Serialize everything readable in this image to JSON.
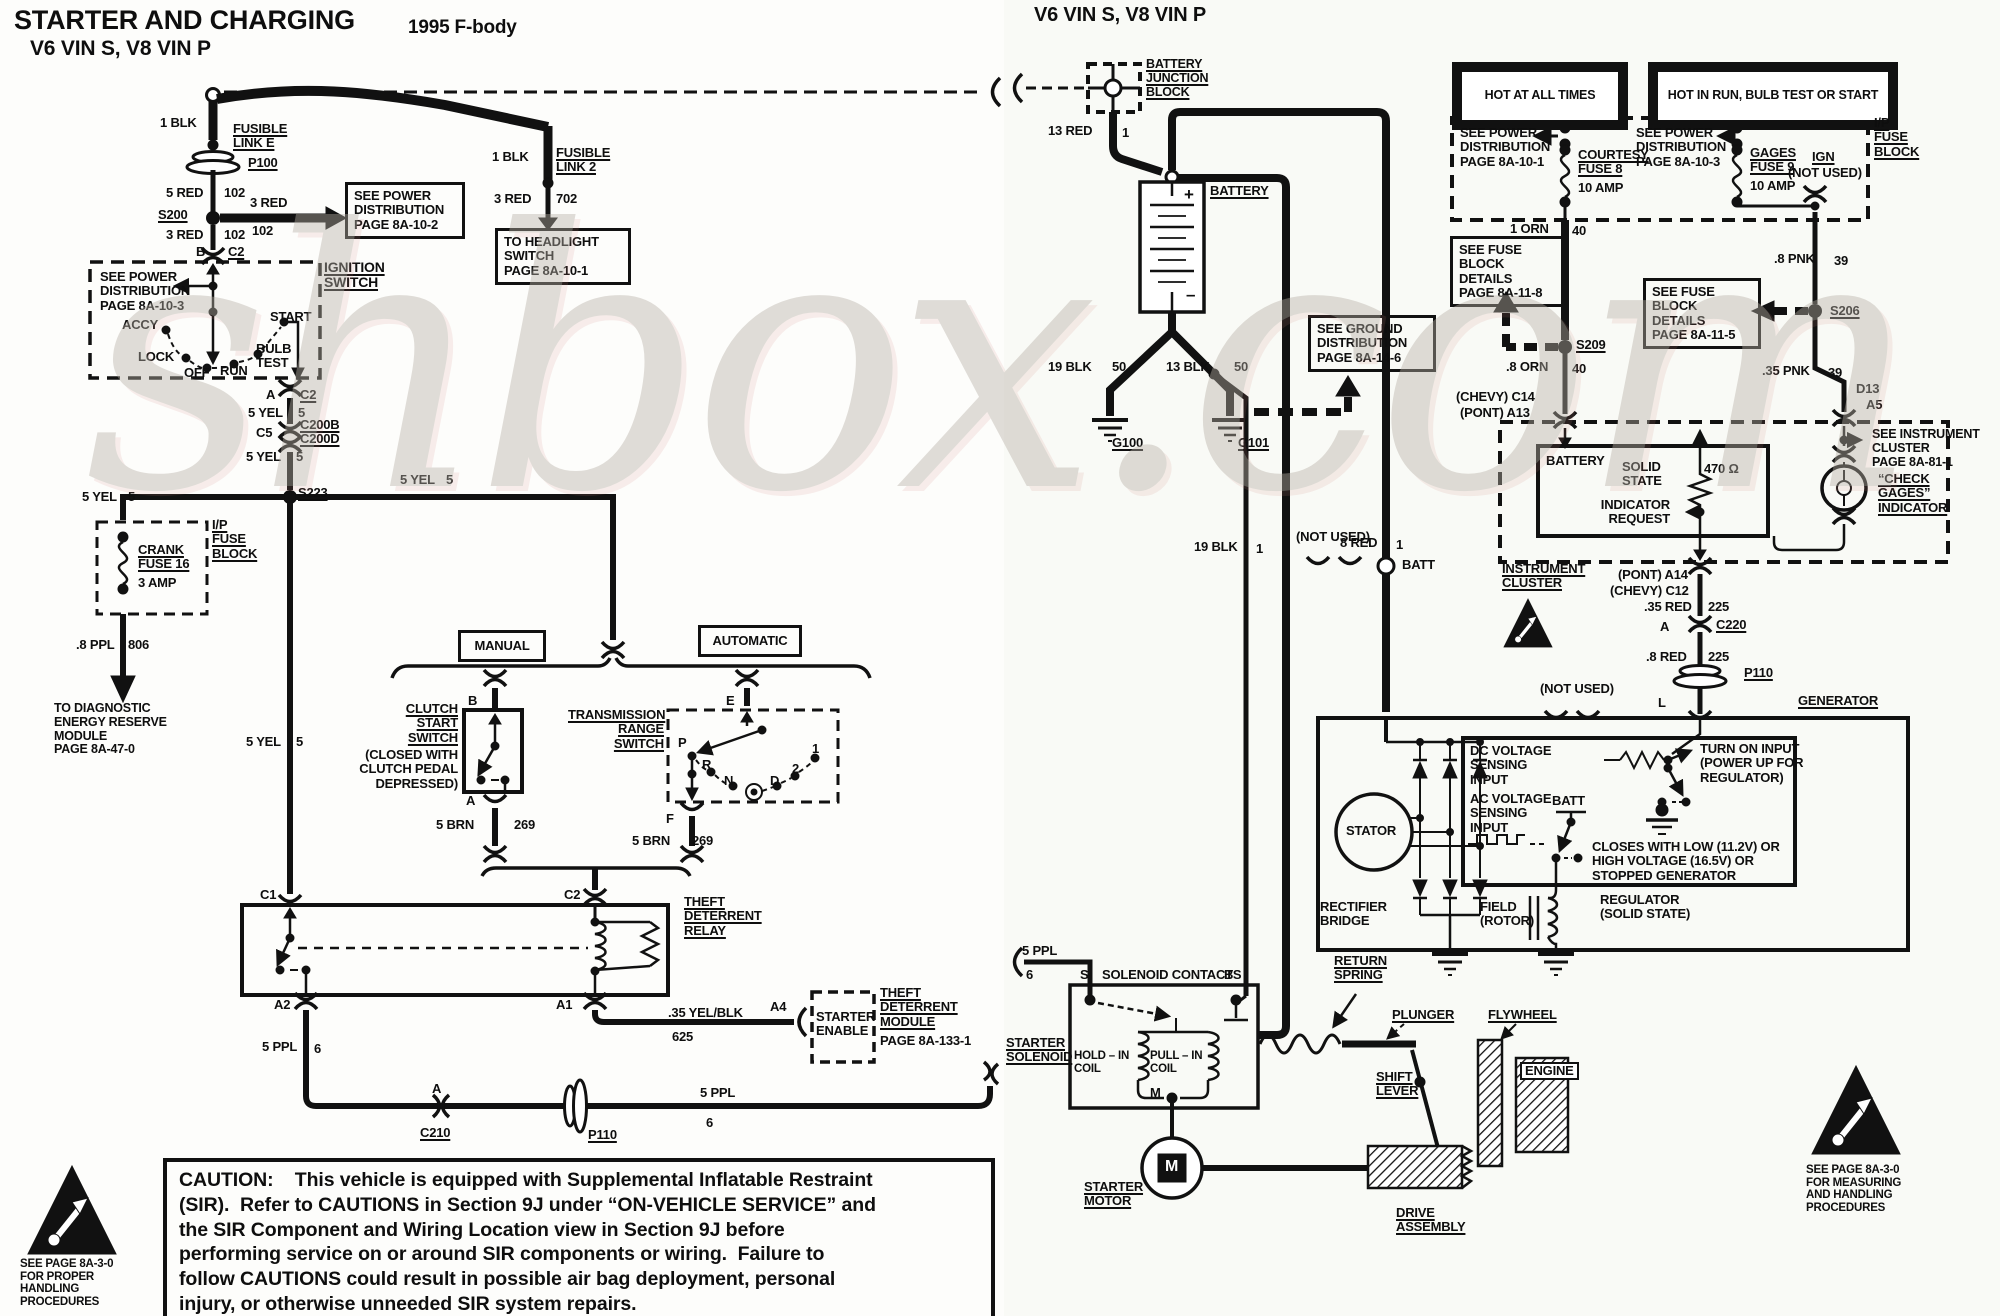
{
  "watermark": "shbox.com",
  "labels": [
    {
      "n": "title-main",
      "t": "STARTER AND CHARGING",
      "x": 14,
      "y": 6,
      "fs": 27
    },
    {
      "n": "title-sub",
      "t": "V6 VIN S, V8 VIN P",
      "x": 30,
      "y": 37,
      "fs": 21
    },
    {
      "n": "title-year",
      "t": "1995 F-body",
      "x": 408,
      "y": 18,
      "fs": 19
    },
    {
      "n": "wire-1blk-left",
      "t": "1 BLK",
      "x": 160,
      "y": 116
    },
    {
      "n": "fusible-link-e",
      "t": "FUSIBLE\nLINK E",
      "x": 233,
      "y": 122,
      "cls": "u"
    },
    {
      "n": "conn-p100-left",
      "t": "P100",
      "x": 248,
      "y": 156,
      "cls": "u"
    },
    {
      "n": "wire-5red",
      "t": "5 RED",
      "x": 166,
      "y": 186
    },
    {
      "n": "wire-5red-ckt",
      "t": "102",
      "x": 224,
      "y": 186
    },
    {
      "n": "splice-s200",
      "t": "S200",
      "x": 158,
      "y": 208,
      "cls": "u"
    },
    {
      "n": "wire-3red-a",
      "t": "3 RED",
      "x": 250,
      "y": 196
    },
    {
      "n": "wire-3red-a-ckt",
      "t": "102",
      "x": 252,
      "y": 224
    },
    {
      "n": "wire-3red-b",
      "t": "3 RED",
      "x": 166,
      "y": 228
    },
    {
      "n": "wire-3red-b-ckt",
      "t": "102",
      "x": 224,
      "y": 228
    },
    {
      "n": "ref-power-dist-8a-10-2",
      "t": "SEE POWER\nDISTRIBUTION\nPAGE 8A-10-2",
      "x": 345,
      "y": 182,
      "w": 102,
      "cls": "box"
    },
    {
      "n": "term-b",
      "t": "B",
      "x": 196,
      "y": 245
    },
    {
      "n": "conn-c2-top",
      "t": "C2",
      "x": 228,
      "y": 245,
      "cls": "u"
    },
    {
      "n": "ignition-switch-label",
      "t": "IGNITION\nSWITCH",
      "x": 324,
      "y": 260,
      "cls": "u",
      "fs": 14
    },
    {
      "n": "ref-power-dist-8a-10-3-left",
      "t": "SEE POWER\nDISTRIBUTION\nPAGE 8A-10-3",
      "x": 100,
      "y": 270
    },
    {
      "n": "ign-pos-accy",
      "t": "ACCY",
      "x": 122,
      "y": 318
    },
    {
      "n": "ign-pos-lock",
      "t": "LOCK",
      "x": 138,
      "y": 350
    },
    {
      "n": "ign-pos-off",
      "t": "OFF",
      "x": 184,
      "y": 366
    },
    {
      "n": "ign-pos-run",
      "t": "RUN",
      "x": 220,
      "y": 364
    },
    {
      "n": "ign-pos-bulbtest",
      "t": "BULB\nTEST",
      "x": 256,
      "y": 342
    },
    {
      "n": "ign-pos-start",
      "t": "START",
      "x": 270,
      "y": 310
    },
    {
      "n": "term-a-ign",
      "t": "A",
      "x": 266,
      "y": 388
    },
    {
      "n": "conn-c2-bot",
      "t": "C2",
      "x": 300,
      "y": 388,
      "cls": "u"
    },
    {
      "n": "wire-5yel-1",
      "t": "5 YEL",
      "x": 248,
      "y": 406
    },
    {
      "n": "wire-5yel-1-ckt",
      "t": "5",
      "x": 298,
      "y": 406
    },
    {
      "n": "term-c5",
      "t": "C5",
      "x": 256,
      "y": 426
    },
    {
      "n": "conn-c200",
      "t": "C200B\nC200D",
      "x": 300,
      "y": 418,
      "cls": "u"
    },
    {
      "n": "wire-5yel-2",
      "t": "5 YEL",
      "x": 246,
      "y": 450
    },
    {
      "n": "wire-5yel-2-ckt",
      "t": "5",
      "x": 296,
      "y": 450
    },
    {
      "n": "splice-s223",
      "t": "S223",
      "x": 298,
      "y": 486,
      "cls": "u"
    },
    {
      "n": "wire-5yel-3",
      "t": "5 YEL",
      "x": 82,
      "y": 490
    },
    {
      "n": "wire-5yel-3-ckt",
      "t": "5",
      "x": 128,
      "y": 490
    },
    {
      "n": "crank-fuse",
      "t": "CRANK\nFUSE 16",
      "x": 138,
      "y": 543,
      "cls": "u"
    },
    {
      "n": "crank-fuse-amp",
      "t": "3 AMP",
      "x": 138,
      "y": 576
    },
    {
      "n": "ip-fuse-block-left",
      "t": "I/P\nFUSE\nBLOCK",
      "x": 212,
      "y": 518,
      "cls": "u"
    },
    {
      "n": "wire-8ppl",
      "t": ".8 PPL",
      "x": 76,
      "y": 638
    },
    {
      "n": "wire-8ppl-ckt",
      "t": "806",
      "x": 128,
      "y": 638
    },
    {
      "n": "ref-diag-energy",
      "t": "TO DIAGNOSTIC\nENERGY RESERVE\nMODULE\nPAGE 8A-47-0",
      "x": 54,
      "y": 702,
      "fs": 12.5
    },
    {
      "n": "wire-1blk-right",
      "t": "1 BLK",
      "x": 492,
      "y": 150
    },
    {
      "n": "fusible-link-2",
      "t": "FUSIBLE\nLINK 2",
      "x": 556,
      "y": 146,
      "cls": "u"
    },
    {
      "n": "wire-3red-702",
      "t": "3 RED",
      "x": 494,
      "y": 192
    },
    {
      "n": "wire-3red-702-ckt",
      "t": "702",
      "x": 556,
      "y": 192
    },
    {
      "n": "ref-headlight-switch",
      "t": "TO HEADLIGHT\nSWITCH\nPAGE 8A-10-1",
      "x": 495,
      "y": 228,
      "w": 118,
      "cls": "box"
    },
    {
      "n": "wire-5yel-4",
      "t": "5 YEL",
      "x": 400,
      "y": 473
    },
    {
      "n": "wire-5yel-4-ckt",
      "t": "5",
      "x": 446,
      "y": 473
    },
    {
      "n": "wire-5yel-5",
      "t": "5 YEL",
      "x": 246,
      "y": 735
    },
    {
      "n": "wire-5yel-5-ckt",
      "t": "5",
      "x": 296,
      "y": 735
    },
    {
      "n": "manual-tag",
      "t": "MANUAL",
      "x": 458,
      "y": 630,
      "w": 82,
      "h": 26,
      "cls": "box acb"
    },
    {
      "n": "automatic-tag",
      "t": "AUTOMATIC",
      "x": 698,
      "y": 625,
      "w": 98,
      "h": 26,
      "cls": "box acb"
    },
    {
      "n": "term-b-clutch",
      "t": "B",
      "x": 468,
      "y": 694
    },
    {
      "n": "clutch-start-switch",
      "t": "CLUTCH\nSTART\nSWITCH",
      "x": 370,
      "y": 702,
      "w": 88,
      "cls": "u ar"
    },
    {
      "n": "clutch-start-note",
      "t": "(CLOSED WITH\nCLUTCH PEDAL\nDEPRESSED)",
      "x": 340,
      "y": 748,
      "w": 118,
      "cls": "ar"
    },
    {
      "n": "term-a-clutch",
      "t": "A",
      "x": 466,
      "y": 794
    },
    {
      "n": "wire-5brn-a",
      "t": "5 BRN",
      "x": 436,
      "y": 818
    },
    {
      "n": "wire-5brn-a-ckt",
      "t": "269",
      "x": 514,
      "y": 818
    },
    {
      "n": "trans-range-switch",
      "t": "TRANSMISSION\nRANGE\nSWITCH",
      "x": 568,
      "y": 708,
      "w": 96,
      "cls": "u ar"
    },
    {
      "n": "term-e",
      "t": "E",
      "x": 726,
      "y": 694
    },
    {
      "n": "trs-pos-p",
      "t": "P",
      "x": 678,
      "y": 736
    },
    {
      "n": "trs-pos-r",
      "t": "R",
      "x": 702,
      "y": 758
    },
    {
      "n": "trs-pos-n",
      "t": "N",
      "x": 724,
      "y": 774
    },
    {
      "n": "trs-pos-d",
      "t": "D",
      "x": 770,
      "y": 774
    },
    {
      "n": "trs-pos-2",
      "t": "2",
      "x": 792,
      "y": 762
    },
    {
      "n": "trs-pos-1",
      "t": "1",
      "x": 812,
      "y": 742
    },
    {
      "n": "term-f",
      "t": "F",
      "x": 666,
      "y": 812
    },
    {
      "n": "wire-5brn-b",
      "t": "5 BRN",
      "x": 632,
      "y": 834
    },
    {
      "n": "wire-5brn-b-ckt",
      "t": "269",
      "x": 692,
      "y": 834
    },
    {
      "n": "term-c1-relay",
      "t": "C1",
      "x": 260,
      "y": 888
    },
    {
      "n": "term-c2-relay",
      "t": "C2",
      "x": 564,
      "y": 888
    },
    {
      "n": "theft-deterrent-relay",
      "t": "THEFT\nDETERRENT\nRELAY",
      "x": 684,
      "y": 895,
      "cls": "u"
    },
    {
      "n": "term-a2",
      "t": "A2",
      "x": 274,
      "y": 998
    },
    {
      "n": "term-a1",
      "t": "A1",
      "x": 556,
      "y": 998
    },
    {
      "n": "wire-5ppl-a",
      "t": "5 PPL",
      "x": 262,
      "y": 1040
    },
    {
      "n": "wire-5ppl-a-ckt",
      "t": "6",
      "x": 314,
      "y": 1042
    },
    {
      "n": "wire-35yelblk",
      "t": ".35 YEL/BLK",
      "x": 668,
      "y": 1006
    },
    {
      "n": "wire-35yelblk-ckt",
      "t": "625",
      "x": 672,
      "y": 1030
    },
    {
      "n": "term-a4",
      "t": "A4",
      "x": 770,
      "y": 1000
    },
    {
      "n": "starter-enable",
      "t": "STARTER\nENABLE",
      "x": 816,
      "y": 1010
    },
    {
      "n": "theft-deterrent-module",
      "t": "THEFT\nDETERRENT\nMODULE",
      "x": 880,
      "y": 986,
      "cls": "u"
    },
    {
      "n": "theft-deterrent-module-page",
      "t": "PAGE 8A-133-1",
      "x": 880,
      "y": 1034
    },
    {
      "n": "term-a-c210",
      "t": "A",
      "x": 432,
      "y": 1082
    },
    {
      "n": "conn-c210",
      "t": "C210",
      "x": 420,
      "y": 1126,
      "cls": "u"
    },
    {
      "n": "conn-p110-left",
      "t": "P110",
      "x": 588,
      "y": 1128,
      "cls": "u"
    },
    {
      "n": "wire-5ppl-b",
      "t": "5 PPL",
      "x": 700,
      "y": 1086
    },
    {
      "n": "wire-5ppl-b-ckt",
      "t": "6",
      "x": 706,
      "y": 1116
    },
    {
      "n": "caution-text",
      "t": "CAUTION:    This vehicle is equipped with Supplemental Inflatable Restraint\n(SIR).  Refer to CAUTIONS in Section 9J under “ON-VEHICLE SERVICE” and\nthe SIR Component and Wiring Location view in Section 9J before\nperforming service on or around SIR components or wiring.  Failure to\nfollow CAUTIONS could result in possible air bag deployment, personal\ninjury, or otherwise unneeded SIR system repairs.",
      "x": 163,
      "y": 1158,
      "w": 800,
      "fs": 19.5,
      "cls": "box cap"
    },
    {
      "n": "esd-note-left",
      "t": "SEE PAGE 8A-3-0\nFOR PROPER\nHANDLING\nPROCEDURES",
      "x": 20,
      "y": 1258,
      "fs": 11.5
    },
    {
      "n": "title-right",
      "t": "V6 VIN S, V8 VIN P",
      "x": 1034,
      "y": 4,
      "fs": 20
    },
    {
      "n": "battery-junction-block",
      "t": "BATTERY\nJUNCTION\nBLOCK",
      "x": 1146,
      "y": 58,
      "cls": "u",
      "fs": 12.5
    },
    {
      "n": "wire-13red",
      "t": "13 RED",
      "x": 1048,
      "y": 124
    },
    {
      "n": "wire-13red-ckt",
      "t": "1",
      "x": 1122,
      "y": 126
    },
    {
      "n": "battery-label",
      "t": "BATTERY",
      "x": 1210,
      "y": 184,
      "cls": "u"
    },
    {
      "n": "battery-plus",
      "t": "+",
      "x": 1184,
      "y": 186,
      "fs": 17
    },
    {
      "n": "battery-minus",
      "t": "–",
      "x": 1186,
      "y": 286,
      "fs": 17
    },
    {
      "n": "wire-19blk-50",
      "t": "19 BLK",
      "x": 1048,
      "y": 360
    },
    {
      "n": "wire-19blk-50-ckt",
      "t": "50",
      "x": 1112,
      "y": 360
    },
    {
      "n": "wire-13blk-50",
      "t": "13 BLK",
      "x": 1166,
      "y": 360
    },
    {
      "n": "wire-13blk-50-ckt",
      "t": "50",
      "x": 1234,
      "y": 360
    },
    {
      "n": "ground-g100",
      "t": "G100",
      "x": 1112,
      "y": 436,
      "cls": "u"
    },
    {
      "n": "ground-g101",
      "t": "G101",
      "x": 1238,
      "y": 436,
      "cls": "u"
    },
    {
      "n": "ref-ground-dist",
      "t": "SEE GROUND\nDISTRIBUTION\nPAGE 8A-14-6",
      "x": 1308,
      "y": 315,
      "w": 110,
      "cls": "box"
    },
    {
      "n": "banner-hot-all-times",
      "t": "HOT AT ALL TIMES",
      "x": 1452,
      "y": 62,
      "w": 150,
      "h": 48,
      "cls": "banner"
    },
    {
      "n": "banner-hot-run",
      "t": "HOT IN RUN, BULB TEST OR START",
      "x": 1648,
      "y": 62,
      "w": 224,
      "h": 48,
      "cls": "banner"
    },
    {
      "n": "ip-fuse-block-right",
      "t": "I/P\nFUSE\nBLOCK",
      "x": 1874,
      "y": 116,
      "cls": "u"
    },
    {
      "n": "ref-power-dist-8a-10-1",
      "t": "SEE POWER\nDISTRIBUTION\nPAGE 8A-10-1",
      "x": 1460,
      "y": 126
    },
    {
      "n": "courtesy-fuse",
      "t": "COURTESY\nFUSE 8",
      "x": 1578,
      "y": 148,
      "cls": "u"
    },
    {
      "n": "courtesy-fuse-amp",
      "t": "10 AMP",
      "x": 1578,
      "y": 181
    },
    {
      "n": "ref-power-dist-8a-10-3-right",
      "t": "SEE POWER\nDISTRIBUTION\nPAGE 8A-10-3",
      "x": 1636,
      "y": 126
    },
    {
      "n": "gages-fuse",
      "t": "GAGES\nFUSE 9",
      "x": 1750,
      "y": 146,
      "cls": "u"
    },
    {
      "n": "gages-fuse-amp",
      "t": "10 AMP",
      "x": 1750,
      "y": 179
    },
    {
      "n": "ign-term",
      "t": "IGN",
      "x": 1812,
      "y": 150,
      "cls": "u"
    },
    {
      "n": "ign-not-used",
      "t": "(NOT USED)",
      "x": 1788,
      "y": 166
    },
    {
      "n": "wire-1orn",
      "t": "1 ORN",
      "x": 1510,
      "y": 222
    },
    {
      "n": "wire-1orn-ckt",
      "t": "40",
      "x": 1572,
      "y": 224
    },
    {
      "n": "ref-fuse-block-8a-11-8",
      "t": "SEE FUSE\nBLOCK DETAILS\nPAGE 8A-11-8",
      "x": 1450,
      "y": 236,
      "w": 100,
      "cls": "box"
    },
    {
      "n": "splice-s209",
      "t": "S209",
      "x": 1576,
      "y": 338,
      "cls": "u"
    },
    {
      "n": "wire-8orn",
      "t": ".8 ORN",
      "x": 1506,
      "y": 360
    },
    {
      "n": "wire-8orn-ckt",
      "t": "40",
      "x": 1572,
      "y": 362
    },
    {
      "n": "conn-c14",
      "t": "(CHEVY) C14",
      "x": 1456,
      "y": 390
    },
    {
      "n": "conn-a13",
      "t": "(PONT) A13",
      "x": 1460,
      "y": 406
    },
    {
      "n": "wire-8pnk",
      "t": ".8 PNK",
      "x": 1774,
      "y": 252
    },
    {
      "n": "wire-8pnk-ckt",
      "t": "39",
      "x": 1834,
      "y": 254
    },
    {
      "n": "ref-fuse-block-8a-11-5",
      "t": "SEE FUSE\nBLOCK DETAILS\nPAGE 8A-11-5",
      "x": 1643,
      "y": 278,
      "w": 100,
      "cls": "box"
    },
    {
      "n": "splice-s206",
      "t": "S206",
      "x": 1830,
      "y": 304,
      "cls": "u"
    },
    {
      "n": "wire-35pnk",
      "t": ".35 PNK",
      "x": 1762,
      "y": 364
    },
    {
      "n": "wire-35pnk-ckt",
      "t": "39",
      "x": 1828,
      "y": 366
    },
    {
      "n": "term-d13",
      "t": "D13",
      "x": 1856,
      "y": 382
    },
    {
      "n": "term-a5",
      "t": "A5",
      "x": 1866,
      "y": 398
    },
    {
      "n": "ref-instrument-cluster",
      "t": "SEE INSTRUMENT\nCLUSTER\nPAGE 8A-81-1",
      "x": 1872,
      "y": 428,
      "fs": 12.5
    },
    {
      "n": "cluster-battery",
      "t": "BATTERY",
      "x": 1546,
      "y": 454
    },
    {
      "n": "cluster-solid-state",
      "t": "SOLID\nSTATE",
      "x": 1622,
      "y": 460
    },
    {
      "n": "cluster-resistor",
      "t": "470 Ω",
      "x": 1704,
      "y": 462
    },
    {
      "n": "indicator-request",
      "t": "INDICATOR\nREQUEST",
      "x": 1598,
      "y": 498,
      "w": 72,
      "cls": "ar"
    },
    {
      "n": "check-gages-indicator",
      "t": "“CHECK\nGAGES”\nINDICATOR",
      "x": 1878,
      "y": 472,
      "cls": "u"
    },
    {
      "n": "instrument-cluster-label",
      "t": "INSTRUMENT\nCLUSTER",
      "x": 1502,
      "y": 562,
      "cls": "u"
    },
    {
      "n": "conn-a14",
      "t": "(PONT) A14",
      "x": 1618,
      "y": 568
    },
    {
      "n": "conn-c12",
      "t": "(CHEVY) C12",
      "x": 1610,
      "y": 584
    },
    {
      "n": "wire-35red",
      "t": ".35 RED",
      "x": 1644,
      "y": 600
    },
    {
      "n": "wire-35red-ckt",
      "t": "225",
      "x": 1708,
      "y": 600
    },
    {
      "n": "term-a-c220",
      "t": "A",
      "x": 1660,
      "y": 620
    },
    {
      "n": "conn-c220",
      "t": "C220",
      "x": 1716,
      "y": 618,
      "cls": "u"
    },
    {
      "n": "wire-8red-225",
      "t": ".8 RED",
      "x": 1646,
      "y": 650
    },
    {
      "n": "wire-8red-225-ckt",
      "t": "225",
      "x": 1708,
      "y": 650
    },
    {
      "n": "conn-p110-right",
      "t": "P110",
      "x": 1744,
      "y": 666,
      "cls": "u"
    },
    {
      "n": "not-used-left",
      "t": "(NOT USED)",
      "x": 1296,
      "y": 530
    },
    {
      "n": "gen-batt-ring",
      "t": "BATT",
      "x": 1402,
      "y": 558
    },
    {
      "n": "not-used-right",
      "t": "(NOT USED)",
      "x": 1540,
      "y": 682
    },
    {
      "n": "term-l",
      "t": "L",
      "x": 1658,
      "y": 696
    },
    {
      "n": "generator-label",
      "t": "GENERATOR",
      "x": 1798,
      "y": 694,
      "cls": "u"
    },
    {
      "n": "wire-19blk-1",
      "t": "19 BLK",
      "x": 1194,
      "y": 540
    },
    {
      "n": "wire-19blk-1-ckt",
      "t": "1",
      "x": 1256,
      "y": 542
    },
    {
      "n": "wire-8red-1",
      "t": "8 RED",
      "x": 1340,
      "y": 536
    },
    {
      "n": "wire-8red-1-ckt",
      "t": "1",
      "x": 1396,
      "y": 538
    },
    {
      "n": "stator-label",
      "t": "STATOR",
      "x": 1346,
      "y": 824
    },
    {
      "n": "rectifier-bridge",
      "t": "RECTIFIER\nBRIDGE",
      "x": 1320,
      "y": 900
    },
    {
      "n": "dc-voltage-sensing",
      "t": "DC VOLTAGE\nSENSING\nINPUT",
      "x": 1470,
      "y": 744
    },
    {
      "n": "ac-voltage-sensing",
      "t": "AC VOLTAGE\nSENSING\nINPUT",
      "x": 1470,
      "y": 792
    },
    {
      "n": "regulator-batt",
      "t": "BATT",
      "x": 1552,
      "y": 794
    },
    {
      "n": "turn-on-input",
      "t": "TURN ON INPUT\n(POWER UP FOR\nREGULATOR)",
      "x": 1700,
      "y": 742
    },
    {
      "n": "closes-with-note",
      "t": "CLOSES WITH LOW (11.2V) OR\nHIGH VOLTAGE (16.5V) OR\nSTOPPED GENERATOR",
      "x": 1592,
      "y": 840
    },
    {
      "n": "field-rotor",
      "t": "FIELD\n(ROTOR)",
      "x": 1480,
      "y": 900
    },
    {
      "n": "regulator-solid-state",
      "t": "REGULATOR\n(SOLID STATE)",
      "x": 1600,
      "y": 893
    },
    {
      "n": "wire-5ppl-c",
      "t": "5 PPL",
      "x": 1022,
      "y": 944
    },
    {
      "n": "wire-5ppl-c-ckt",
      "t": "6",
      "x": 1026,
      "y": 968
    },
    {
      "n": "starter-solenoid-label",
      "t": "STARTER\nSOLENOID",
      "x": 1006,
      "y": 1036,
      "cls": "u"
    },
    {
      "n": "term-s",
      "t": "S",
      "x": 1080,
      "y": 968
    },
    {
      "n": "solenoid-contacts",
      "t": "SOLENOID CONTACTS",
      "x": 1102,
      "y": 968
    },
    {
      "n": "term-b-solenoid",
      "t": "B",
      "x": 1224,
      "y": 968
    },
    {
      "n": "hold-in-coil",
      "t": "HOLD – IN\nCOIL",
      "x": 1074,
      "y": 1050,
      "fs": 11.5
    },
    {
      "n": "pull-in-coil",
      "t": "PULL – IN\nCOIL",
      "x": 1150,
      "y": 1050,
      "fs": 11.5
    },
    {
      "n": "term-m",
      "t": "M",
      "x": 1150,
      "y": 1086
    },
    {
      "n": "return-spring",
      "t": "RETURN\nSPRING",
      "x": 1334,
      "y": 954,
      "cls": "u"
    },
    {
      "n": "plunger-label",
      "t": "PLUNGER",
      "x": 1392,
      "y": 1008,
      "cls": "u"
    },
    {
      "n": "flywheel-label",
      "t": "FLYWHEEL",
      "x": 1488,
      "y": 1008,
      "cls": "u"
    },
    {
      "n": "shift-lever",
      "t": "SHIFT\nLEVER",
      "x": 1376,
      "y": 1070,
      "cls": "u"
    },
    {
      "n": "engine-label",
      "t": "ENGINE",
      "x": 1520,
      "y": 1062,
      "cls": "engine-tag"
    },
    {
      "n": "starter-motor-label",
      "t": "STARTER\nMOTOR",
      "x": 1084,
      "y": 1180,
      "cls": "u"
    },
    {
      "n": "starter-motor-m",
      "t": "M",
      "x": 1165,
      "y": 1158,
      "cls": "inv",
      "fs": 16
    },
    {
      "n": "drive-assembly",
      "t": "DRIVE\nASSEMBLY",
      "x": 1396,
      "y": 1206,
      "cls": "u"
    },
    {
      "n": "esd-note-right",
      "t": "SEE PAGE 8A-3-0\nFOR MEASURING\nAND HANDLING\nPROCEDURES",
      "x": 1806,
      "y": 1164,
      "fs": 11.5
    }
  ]
}
